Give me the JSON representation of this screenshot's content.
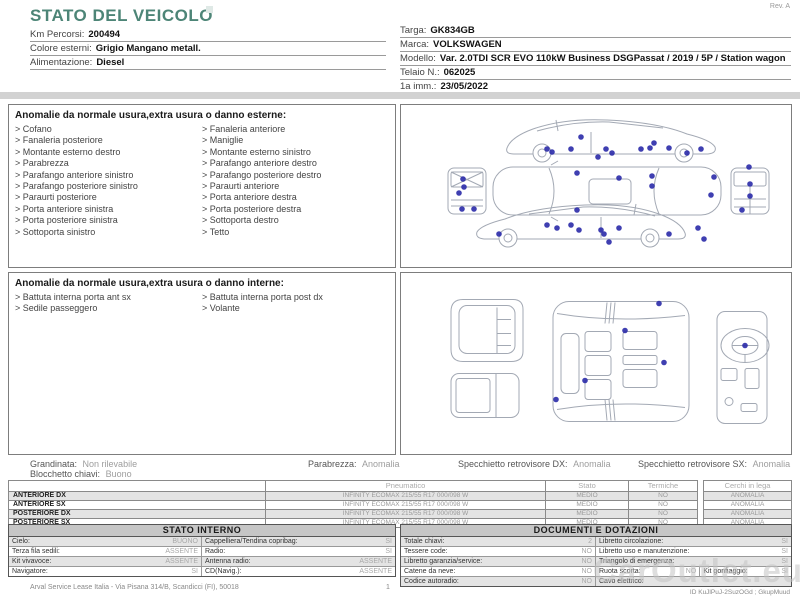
{
  "colors": {
    "accent_teal": "#4d8577",
    "marker_blue": "#2a2aa8",
    "diagram_stroke": "#a3a9b4"
  },
  "header": {
    "title": "STATO DEL VEICOLO",
    "rev": "Rev. A",
    "left_fields": [
      {
        "label": "Km Percorsi:",
        "value": "200494"
      },
      {
        "label": "Colore esterni:",
        "value": "Grigio Mangano metall."
      },
      {
        "label": "Alimentazione:",
        "value": "Diesel"
      }
    ],
    "right_fields": [
      {
        "label": "Targa:",
        "value": "GK834GB"
      },
      {
        "label": "Marca:",
        "value": "VOLKSWAGEN"
      },
      {
        "label": "Modello:",
        "value": "Var. 2.0TDI SCR EVO 110kW Business DSGPassat / 2019 / 5P / Station wagon"
      },
      {
        "label": "Telaio N.:",
        "value": "062025"
      },
      {
        "label": "1a imm.:",
        "value": "23/05/2022"
      }
    ]
  },
  "exterior": {
    "title": "Anomalie da normale usura,extra usura o danno esterne:",
    "items_left": [
      "Cofano",
      "Fanaleria posteriore",
      "Montante esterno destro",
      "Parabrezza",
      "Parafango anteriore sinistro",
      "Parafango posteriore sinistro",
      "Paraurti posteriore",
      "Porta anteriore sinistra",
      "Porta posteriore sinistra",
      "Sottoporta sinistro"
    ],
    "items_right": [
      "Fanaleria anteriore",
      "Maniglie",
      "Montante esterno sinistro",
      "Parafango anteriore destro",
      "Parafango posteriore destro",
      "Paraurti anteriore",
      "Porta anteriore destra",
      "Porta posteriore destra",
      "Sottoporta destro",
      "Tetto"
    ]
  },
  "interior": {
    "title": "Anomalie da normale usura,extra usura o danno interne:",
    "items_left": [
      "Battuta interna porta ant sx",
      "Sedile passeggero"
    ],
    "items_right": [
      "Battuta interna porta post dx",
      "Volante"
    ]
  },
  "diagrams": {
    "exterior_markers": [
      [
        180,
        30
      ],
      [
        146,
        42
      ],
      [
        151,
        45
      ],
      [
        170,
        42
      ],
      [
        205,
        42
      ],
      [
        211,
        46
      ],
      [
        240,
        42
      ],
      [
        249,
        41
      ],
      [
        253,
        36
      ],
      [
        268,
        41
      ],
      [
        286,
        46
      ],
      [
        300,
        42
      ],
      [
        197,
        50
      ],
      [
        176,
        66
      ],
      [
        218,
        71
      ],
      [
        251,
        69
      ],
      [
        251,
        79
      ],
      [
        310,
        88
      ],
      [
        313,
        70
      ],
      [
        176,
        103
      ],
      [
        62,
        72
      ],
      [
        63,
        80
      ],
      [
        58,
        86
      ],
      [
        61,
        102
      ],
      [
        73,
        102
      ],
      [
        348,
        60
      ],
      [
        349,
        77
      ],
      [
        349,
        89
      ],
      [
        341,
        103
      ],
      [
        98,
        127
      ],
      [
        146,
        118
      ],
      [
        156,
        121
      ],
      [
        170,
        118
      ],
      [
        178,
        123
      ],
      [
        200,
        123
      ],
      [
        203,
        127
      ],
      [
        208,
        135
      ],
      [
        218,
        121
      ],
      [
        268,
        127
      ],
      [
        297,
        121
      ],
      [
        303,
        132
      ]
    ],
    "interior_markers": [
      [
        258,
        30
      ],
      [
        224,
        57
      ],
      [
        263,
        89
      ],
      [
        184,
        107
      ],
      [
        155,
        126
      ],
      [
        344,
        72
      ]
    ]
  },
  "summary": {
    "items": [
      {
        "label": "Grandinata:",
        "value": "Non rilevabile"
      },
      {
        "label": "Parabrezza:",
        "value": "Anomalia"
      },
      {
        "label": "Specchietto retrovisore DX:",
        "value": "Anomalia"
      },
      {
        "label": "Specchietto retrovisore SX:",
        "value": "Anomalia"
      }
    ],
    "line2": {
      "label": "Blocchetto chiavi:",
      "value": "Buono"
    }
  },
  "tires": {
    "headers": {
      "col1": "Pneumatico",
      "col2": "Stato",
      "col3": "Termiche"
    },
    "wheels_header": "Cerchi in lega",
    "rows": [
      {
        "position": "ANTERIORE DX",
        "tire": "INFINITY  ECOMAX 215/55 R17 000/098 W",
        "stato": "MEDIO",
        "termiche": "NO",
        "cerchi": "ANOMALIA"
      },
      {
        "position": "ANTERIORE SX",
        "tire": "INFINITY  ECOMAX 215/55 R17 000/098 W",
        "stato": "MEDIO",
        "termiche": "NO",
        "cerchi": "ANOMALIA"
      },
      {
        "position": "POSTERIORE DX",
        "tire": "INFINITY  ECOMAX 215/55 R17 000/098 W",
        "stato": "MEDIO",
        "termiche": "NO",
        "cerchi": "ANOMALIA"
      },
      {
        "position": "POSTERIORE SX",
        "tire": "INFINITY  ECOMAX 215/55 R17 000/098 W",
        "stato": "MEDIO",
        "termiche": "NO",
        "cerchi": "ANOMALIA"
      }
    ]
  },
  "stato_interno": {
    "title": "STATO INTERNO",
    "rows": [
      {
        "l1": "Cielo:",
        "v1": "BUONO",
        "l2": "Cappelliera/Tendina copribag:",
        "v2": "SI"
      },
      {
        "l1": "Terza fila sedili:",
        "v1": "ASSENTE",
        "l2": "Radio:",
        "v2": "SI"
      },
      {
        "l1": "Kit vivavoce:",
        "v1": "ASSENTE",
        "l2": "Antenna radio:",
        "v2": "ASSENTE"
      },
      {
        "l1": "Navigatore:",
        "v1": "SI",
        "l2": "CD(Navig.):",
        "v2": "ASSENTE"
      }
    ]
  },
  "documenti": {
    "title": "DOCUMENTI E DOTAZIONI",
    "rows": [
      {
        "l1": "Totale chiavi:",
        "v1": "2",
        "l2": "Libretto circolazione:",
        "v2": "SI"
      },
      {
        "l1": "Tessere code:",
        "v1": "NO",
        "l2": "Libretto uso e manutenzione:",
        "v2": "SI"
      },
      {
        "l1": "Libretto garanzia/service:",
        "v1": "NO",
        "l2": "Triangolo di emergenza:",
        "v2": "SI"
      },
      {
        "l1": "Catene da neve:",
        "v1": "NO",
        "l2": "Ruota scorta:",
        "v2": "NO",
        "l3": "Kit gonfiaggio:",
        "v3": "SI"
      },
      {
        "l1": "Codice autoradio:",
        "v1": "NO",
        "l2": "Cavo elettrico:",
        "v2": ""
      }
    ]
  },
  "footer": {
    "address": "Arval Service Lease Italia - Via Pisana 314/B, Scandicci (FI), 50018",
    "page": "1",
    "doc_id": "ID KuJlPuJ-2SuzOGd ; GkupMuud",
    "watermark": "CarOutlet.eu"
  }
}
